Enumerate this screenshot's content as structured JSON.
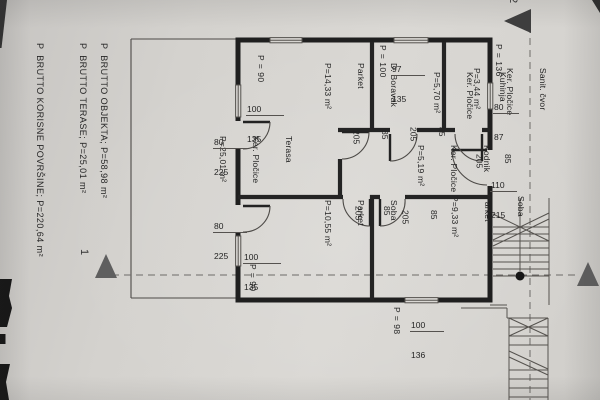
{
  "summary": {
    "lines": [
      "P  BRUTTO OBJEKTA; P=58,98 m²",
      "P  BRUTTO TERASE; P=25,01 m²",
      "P  BRUTTO KORISNE POVRŠINE; P=220,64 m²"
    ]
  },
  "axis_markers": {
    "left": "1",
    "top": "2"
  },
  "rooms": [
    {
      "name": "Terasa",
      "floor": "Ker. Pločice",
      "area": "P=25,01 m²"
    },
    {
      "name": "D. Boravak",
      "floor": "Parket",
      "area": "P=14,33 m²"
    },
    {
      "name": "Kuhinja",
      "floor": "Ker. Pločice",
      "area": "P=5,70 m²"
    },
    {
      "name": "Sanit. čvor",
      "floor": "Ker. Pločice",
      "area": "P=3,44 m²"
    },
    {
      "name": "Kodnik",
      "floor": "Ker. Pločice",
      "area": "P=5,19 m²"
    },
    {
      "name": "Soba",
      "floor": "Parket",
      "area": "P=10,55 m²"
    },
    {
      "name": "Soba",
      "floor": "Parket",
      "area": "P=9,33 m²"
    }
  ],
  "dims": {
    "windows": [
      {
        "w": "100",
        "h": "135"
      },
      {
        "w": "80",
        "h": "225"
      },
      {
        "w": "80",
        "h": "225"
      },
      {
        "w": "100",
        "h": "135"
      },
      {
        "w": "97",
        "h": "135"
      },
      {
        "w": "80",
        "h": "87"
      },
      {
        "w": "110",
        "h": "215"
      },
      {
        "w": "100",
        "h": "136"
      }
    ],
    "doors": [
      {
        "w": "85",
        "h": "205"
      },
      {
        "w": "85",
        "h": "205"
      },
      {
        "w": "85",
        "h": "205"
      },
      {
        "w": "85",
        "h": "205"
      },
      {
        "w": "85",
        "h": "205"
      }
    ],
    "parapets": [
      "P = 90",
      "P = 100",
      "P = 136",
      "P = 90",
      "P = 98"
    ]
  },
  "colors": {
    "paper": "#d5d3cf",
    "wall": "#1f1f1f",
    "thin_line": "#55524f",
    "axis_triangle": "#5f5f5f",
    "marker_triangle": "#3e3e3e"
  }
}
